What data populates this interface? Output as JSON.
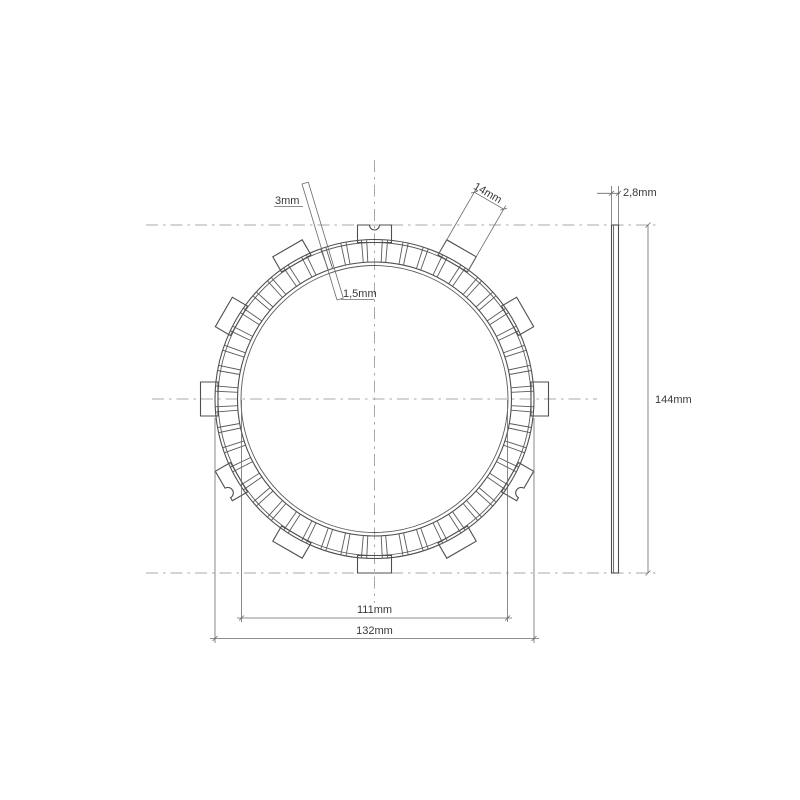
{
  "drawing": {
    "colors": {
      "background": "#ffffff",
      "line": "#4f4f4f",
      "centerline": "#a8a8a8",
      "label": "#3a3a3a"
    },
    "front_view": {
      "pad_count": 48,
      "tab_count": 12
    },
    "labels": {
      "pad_material_thickness": "3mm",
      "tab_width": "14mm",
      "groove": "1,5mm",
      "plate_thickness": "2,8mm",
      "overall_height": "144mm",
      "inner_diameter": "111mm",
      "outer_diameter": "132mm"
    }
  }
}
